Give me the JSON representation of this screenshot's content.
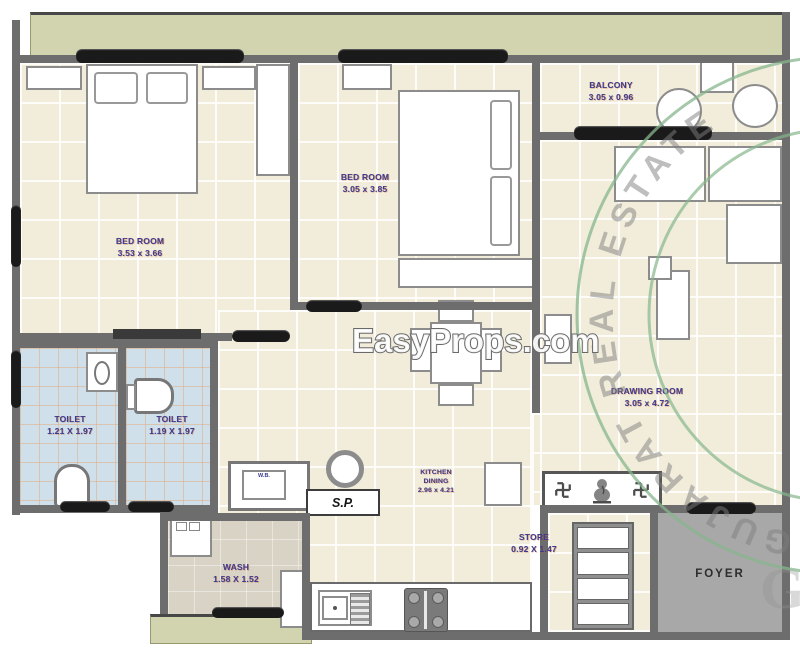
{
  "rooms": {
    "bedroom1": {
      "label": "BED ROOM",
      "dim": "3.53 x 3.66"
    },
    "bedroom2": {
      "label": "BED ROOM",
      "dim": "3.05 x 3.85"
    },
    "balcony": {
      "label": "BALCONY",
      "dim": "3.05 x 0.96"
    },
    "drawing_room": {
      "label": "DRAWING ROOM",
      "dim": "3.05 x 4.72"
    },
    "toilet1": {
      "label": "TOILET",
      "dim": "1.21 X 1.97"
    },
    "toilet2": {
      "label": "TOILET",
      "dim": "1.19 X 1.97"
    },
    "kitchen": {
      "label": "KITCHEN",
      "label2": "DINING",
      "dim": "2.96 x 4.21"
    },
    "store": {
      "label": "STORE",
      "dim": "0.92 X 1.47"
    },
    "wash": {
      "label": "WASH",
      "dim": "1.58 X 1.52"
    },
    "foyer": {
      "label": "FOYER"
    }
  },
  "annotations": {
    "soil_pipe": "S.P.",
    "wash_basin": "W.B."
  },
  "watermark": {
    "site": "EasyProps.com",
    "seal": "GUJARAT REAL ESTATE",
    "monogram": "G"
  },
  "icons": {
    "swastika": "swastika-glyph",
    "ganesha": "deity-figure"
  },
  "colors": {
    "wall": "#6d6d6d",
    "floor_cream": "#f2edda",
    "toilet_floor": "#cfe0eb",
    "olive_band": "#d2d4b0",
    "foyer_gray": "#a8a8a8",
    "wash_floor": "#d8d3c5",
    "label_navy": "#3b3b92",
    "seal_green": "#86b68c",
    "window_black": "#1a1a1a"
  }
}
